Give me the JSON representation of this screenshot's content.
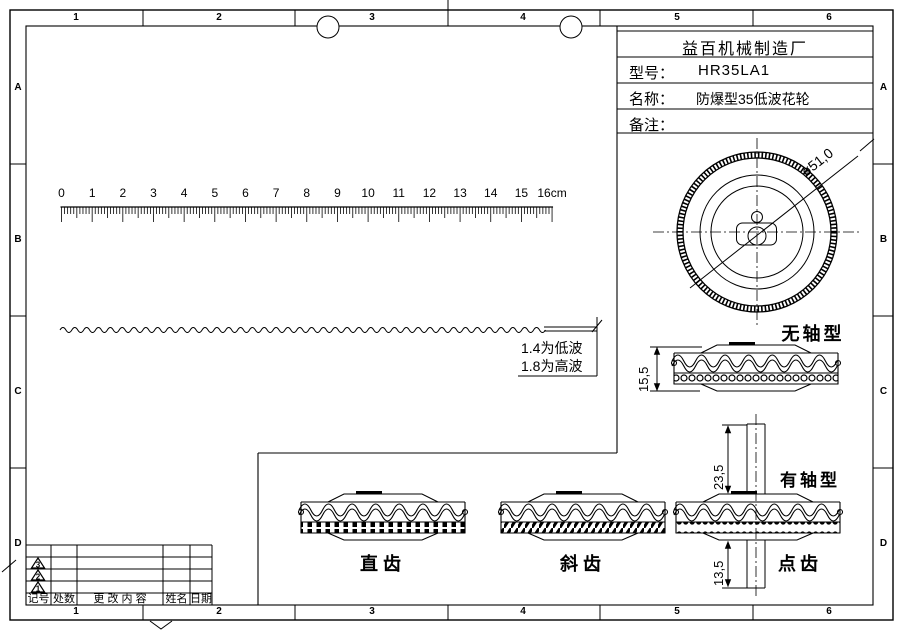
{
  "sheet": {
    "company": "益百机械制造厂",
    "model_label": "型号：",
    "model_value": "HR35LA1",
    "name_label": "名称：",
    "name_value": "防爆型35低波花轮",
    "remark_label": "备注："
  },
  "border": {
    "top_zones": [
      "1",
      "2",
      "3",
      "4",
      "5",
      "6"
    ],
    "bottom_zones": [
      "1",
      "2",
      "3",
      "4",
      "5",
      "6"
    ],
    "left_zones": [
      "A",
      "B",
      "C",
      "D"
    ],
    "right_zones": [
      "A",
      "B",
      "C",
      "D"
    ]
  },
  "ruler": {
    "unit": "cm",
    "labels": [
      "0",
      "1",
      "2",
      "3",
      "4",
      "5",
      "6",
      "7",
      "8",
      "9",
      "10",
      "11",
      "12",
      "13",
      "14",
      "15",
      "16cm"
    ]
  },
  "wave_note": {
    "line1": "1.4为低波",
    "line2": "1.8为高波"
  },
  "dimensions": {
    "diameter": "ø51,0",
    "thickness": "15,5",
    "shaft_top_length": "23,5",
    "shaft_bottom_length": "13,5"
  },
  "type_labels": {
    "no_shaft": "无轴型",
    "with_shaft": "有轴型",
    "straight_tooth": "直齿",
    "helical_tooth": "斜齿",
    "dot_tooth": "点齿"
  },
  "revision_table": {
    "headers": [
      "记号",
      "处数",
      "更  改  内  容",
      "姓名",
      "日期"
    ],
    "marks": [
      "3",
      "2",
      "1"
    ]
  },
  "colors": {
    "line": "#000000",
    "background": "#ffffff"
  }
}
